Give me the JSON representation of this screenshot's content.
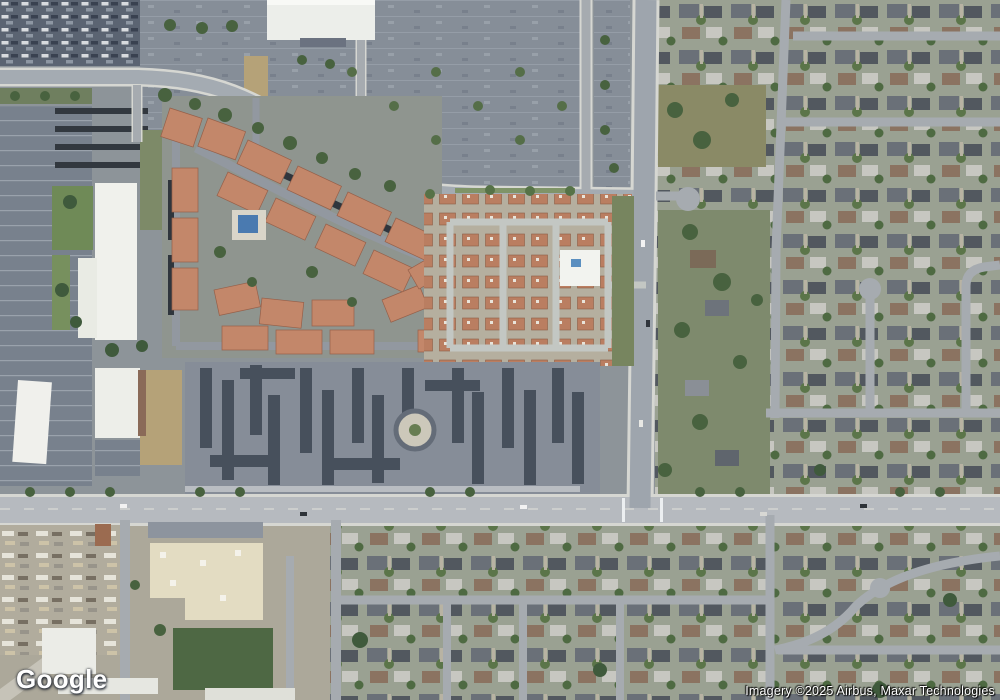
{
  "watermark": {
    "logo_text": "Google"
  },
  "attribution": {
    "text": "Imagery ©2025 Airbus, Maxar Technologies"
  },
  "palette": {
    "road_arterial": "#b6babf",
    "road_minor": "#a6abb0",
    "road_casing": "#d6d7d2",
    "parking_lot": "#868e98",
    "parking_dark": "#5b6472",
    "roof_terracotta": "#c3876a",
    "roof_cottage": "#ba7e61",
    "roof_dark_apartment": "#47505c",
    "roof_white": "#f0f1ec",
    "warehouse_beige": "#e3dcc2",
    "grass": "#6f8a57",
    "tree": "#48623f",
    "dirt": "#b5a278",
    "pool": "#4a7ab0",
    "residential_base": "#9aa192"
  }
}
